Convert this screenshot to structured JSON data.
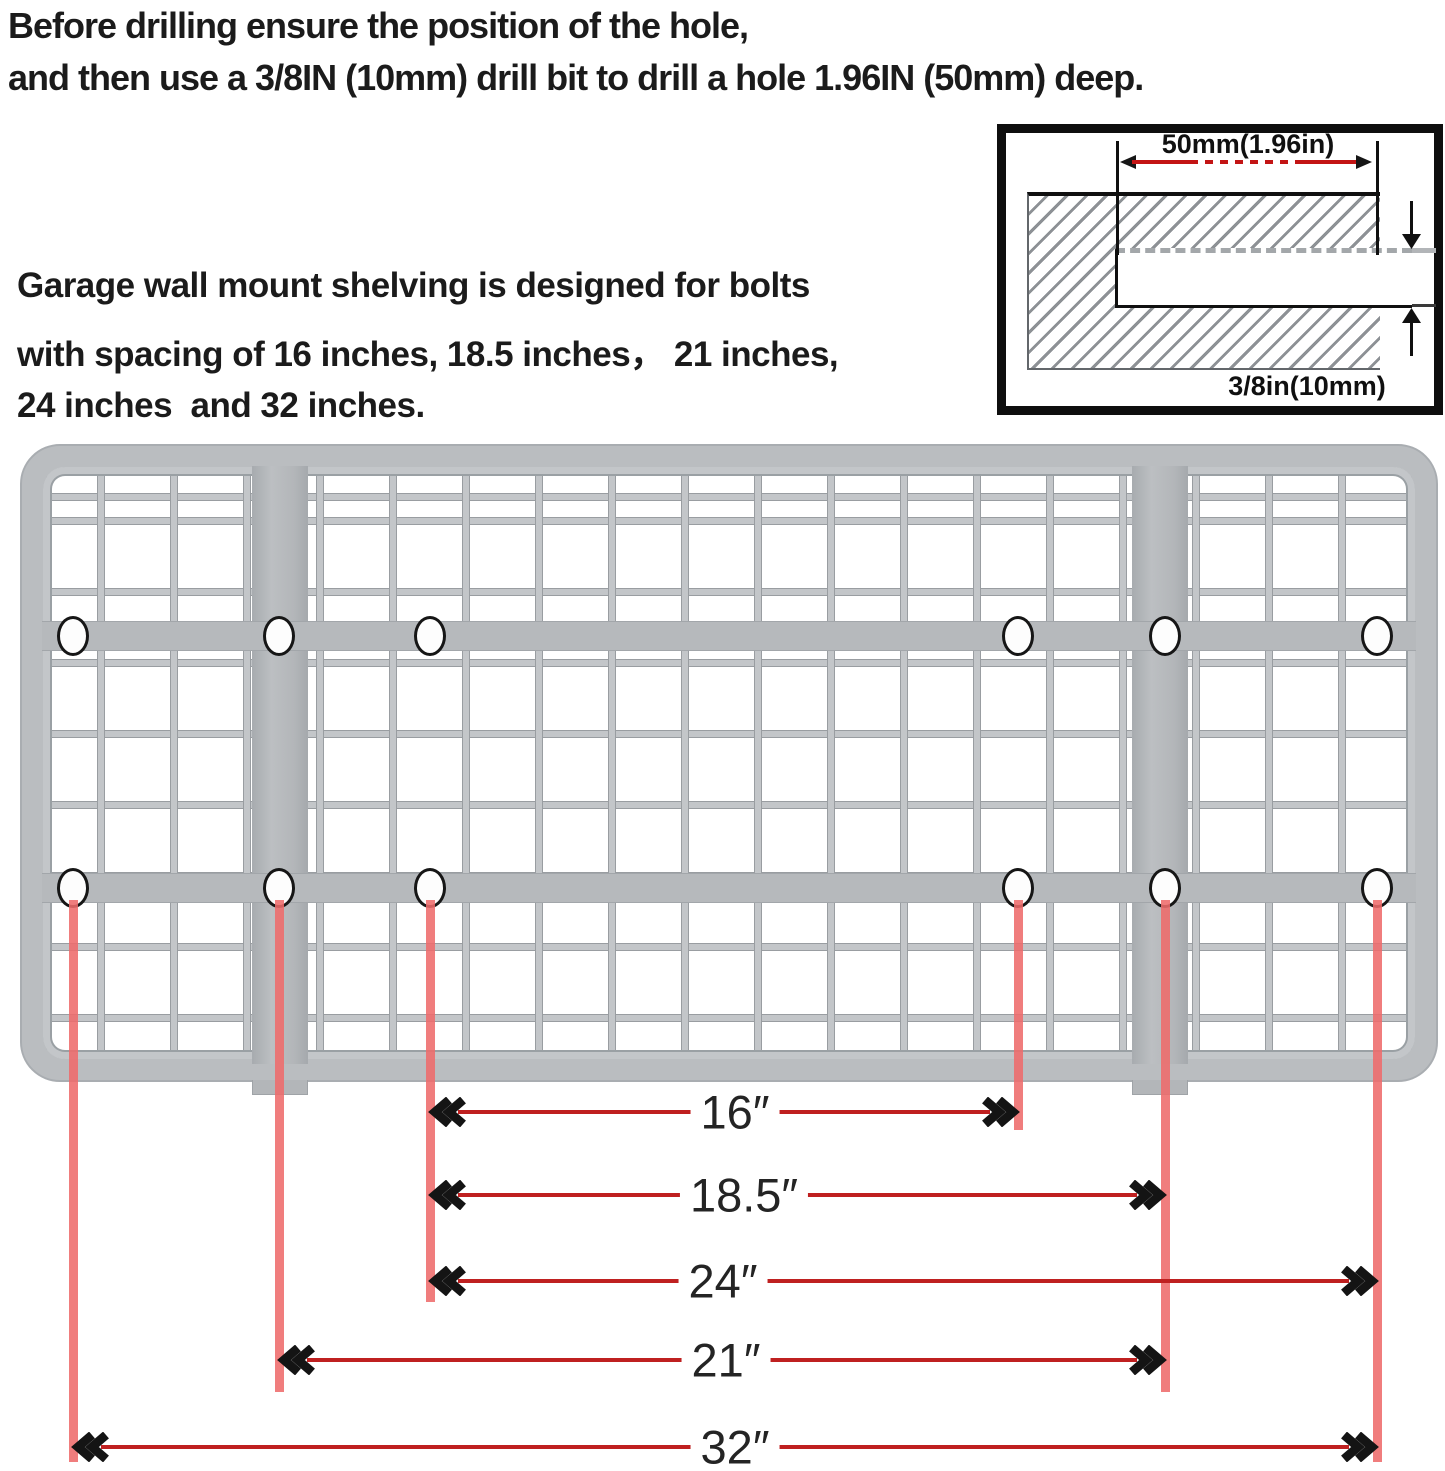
{
  "title": {
    "line1": "Before drilling ensure the position of the hole,",
    "line2": "and then use a 3/8IN (10mm) drill bit to drill a hole 1.96IN (50mm) deep."
  },
  "description": {
    "line1": "Garage wall mount shelving is designed for bolts",
    "line2": "with spacing of 16 inches, 18.5 inches， 21 inches,",
    "line3": "24 inches  and 32 inches."
  },
  "inset": {
    "depth_label": "50mm(1.96in)",
    "diameter_label": "3/8in(10mm)"
  },
  "dimensions": [
    {
      "label": "16″",
      "from_hole": 3,
      "to_hole": 4
    },
    {
      "label": "18.5″",
      "from_hole": 3,
      "to_hole": 5
    },
    {
      "label": "24″",
      "from_hole": 3,
      "to_hole": 6
    },
    {
      "label": "21″",
      "from_hole": 2,
      "to_hole": 5
    },
    {
      "label": "32″",
      "from_hole": 1,
      "to_hole": 6
    }
  ],
  "colors": {
    "dimension_line_red": "#bf2020",
    "guide_line_red": "#ee6b6b",
    "inset_dimension_red": "#c31414",
    "panel_gray": "#babdc0",
    "text_black": "#1b1b1b"
  }
}
